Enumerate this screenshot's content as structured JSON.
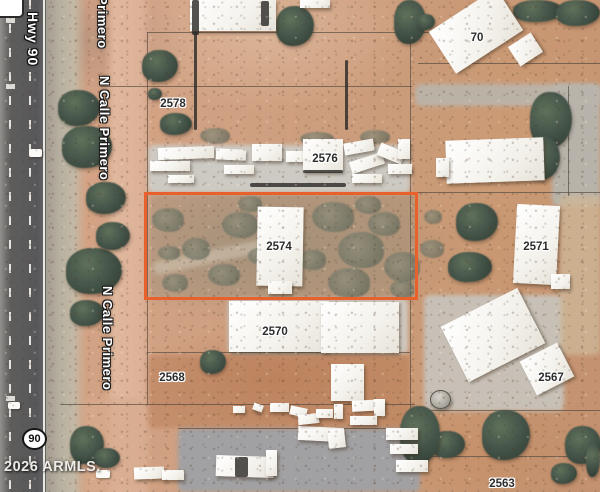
{
  "map": {
    "description": "Aerial satellite parcel map with highlighted lot 2574",
    "copyright": "2026 ARMLS.",
    "highway_label": "Hwy 90",
    "highway_shield": "90",
    "street_name": "N Calle Primero",
    "street_labels": [
      {
        "text": "Primero",
        "x": 110,
        "y": -4
      },
      {
        "text": "N Calle Primero",
        "x": 112,
        "y": 76
      },
      {
        "text": "N Calle Primero",
        "x": 115,
        "y": 286
      }
    ],
    "parcel_labels": [
      {
        "text": "2578",
        "x": 173,
        "y": 104
      },
      {
        "text": "2576",
        "x": 325,
        "y": 159
      },
      {
        "text": "2574",
        "x": 279,
        "y": 247
      },
      {
        "text": "2570",
        "x": 275,
        "y": 332
      },
      {
        "text": "2568",
        "x": 172,
        "y": 378
      },
      {
        "text": "70",
        "x": 477,
        "y": 38
      },
      {
        "text": "2571",
        "x": 536,
        "y": 247
      },
      {
        "text": "2567",
        "x": 551,
        "y": 378
      },
      {
        "text": "2563",
        "x": 502,
        "y": 484
      }
    ],
    "highlighted_parcel": {
      "number": "2574",
      "outline_color": "#e8612c"
    },
    "label_colors": {
      "street_text": "#ffffff",
      "street_halo": "#1a1a1a",
      "parcel_text": "#2c2c2c",
      "parcel_halo": "#ffffff"
    }
  }
}
